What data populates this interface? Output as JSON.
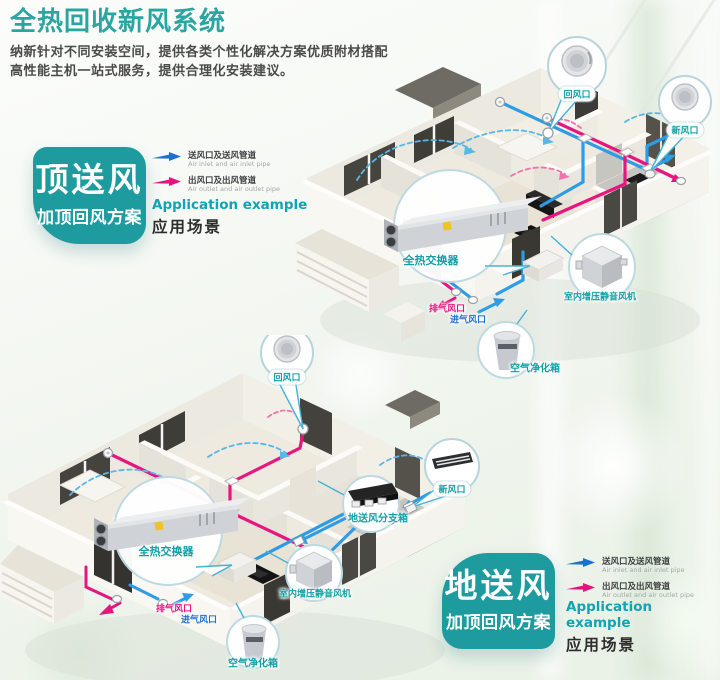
{
  "page": {
    "title": "全热回收新风系统",
    "subtitle1": "纳新针对不同安装空间，提供各类个性化解决方案优质附材搭配",
    "subtitle2": "高性能主机一站式服务，提供合理化安装建议。"
  },
  "colors": {
    "teal_accent": "#1d9b9e",
    "title_teal": "#2aa5a2",
    "duct_blue": "#2d9ce4",
    "duct_pink": "#e9157f",
    "legend_blue": "#1c6fd3",
    "legend_pink": "#e6137f"
  },
  "legend": {
    "inlet_cn": "送风口及送风管道",
    "inlet_en": "Air inlet and air inlet pipe",
    "outlet_cn": "出风口及出风管道",
    "outlet_en": "Air outlet and air outlet pipe",
    "example_en": "Application example",
    "example_cn": "应用场景"
  },
  "scheme_top": {
    "badge_main": "顶送风",
    "badge_sub": "加顶回风方案"
  },
  "scheme_bottom": {
    "badge_main": "地送风",
    "badge_sub": "加顶回风方案"
  },
  "diagram_top": {
    "labels": {
      "return_vent": "回风口",
      "fresh_vent": "新风口",
      "heat_exchanger": "全热交换器",
      "booster_fan": "室内增压静音风机",
      "exhaust_vent": "排气风口",
      "intake_vent": "进气风口",
      "purifier": "空气净化箱"
    }
  },
  "diagram_bottom": {
    "labels": {
      "return_vent": "回风口",
      "fresh_vent": "新风口",
      "heat_exchanger": "全热交换器",
      "booster_fan": "室内增压静音风机",
      "exhaust_vent": "排气风口",
      "intake_vent": "进气风口",
      "purifier": "空气净化箱",
      "floor_dist_box": "地送风分支箱"
    }
  }
}
